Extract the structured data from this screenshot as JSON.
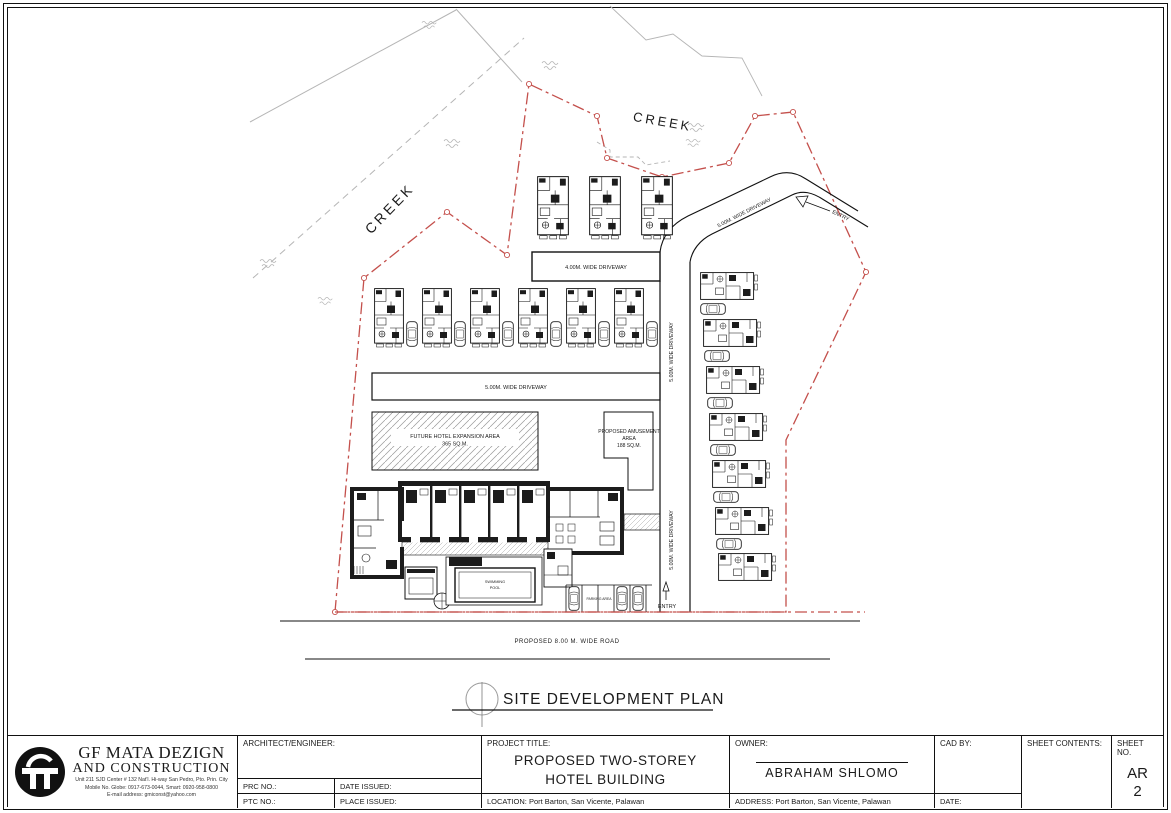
{
  "plan": {
    "title": "SITE DEVELOPMENT PLAN",
    "labels": {
      "creek_top": "CREEK",
      "creek_left": "CREEK",
      "driveway_top": "4.00M. WIDE DRIVEWAY",
      "driveway_mid": "5.00M. WIDE DRIVEWAY",
      "driveway_right_upper": "5.00M. WIDE DRIVEWAY",
      "driveway_right_lower": "5.00M. WIDE DRIVEWAY",
      "driveway_diag": "5.00M. WIDE DRIVEWAY",
      "entry_top": "ENTRY",
      "entry_bottom": "ENTRY",
      "expansion_line1": "FUTURE HOTEL EXPANSION AREA",
      "expansion_line2": "365 SQ.M.",
      "amusement_line1": "PROPOSED AMUSEMENT",
      "amusement_line2": "AREA",
      "amusement_line3": "188 SQ.M.",
      "pool_line1": "SWIMMING",
      "pool_line2": "POOL",
      "parking": "PARKING AREA",
      "road": "PROPOSED 8.00 M. WIDE ROAD"
    },
    "colors": {
      "boundary": "#c4504c",
      "creek": "#b5b5b5"
    }
  },
  "title_block": {
    "company": {
      "name_line1": "GF MATA DEZIGN",
      "name_line2": "AND CONSTRUCTION",
      "address": "Unit 211 SJD Center # 132 Nat'l. Hi-way San Pedro, Pto. Prin. City",
      "mobile": "Mobile No. Globe: 0917-673-0044, Smart: 0920-958-0800",
      "email": "E-mail address: gmiconst@yahoo.com"
    },
    "architect_label": "ARCHITECT/ENGINEER:",
    "prc_label": "PRC NO.:",
    "date_issued_label": "DATE ISSUED:",
    "ptc_label": "PTC NO.:",
    "place_issued_label": "PLACE ISSUED:",
    "project_title_label": "PROJECT TITLE:",
    "project_title_line1": "PROPOSED TWO-STOREY",
    "project_title_line2": "HOTEL BUILDING",
    "location": "LOCATION: Port Barton, San Vicente, Palawan",
    "owner_label": "OWNER:",
    "owner_name": "ABRAHAM SHLOMO",
    "address": "ADDRESS: Port Barton, San Vicente, Palawan",
    "cad_by_label": "CAD BY:",
    "date_label": "DATE:",
    "sheet_contents_label": "SHEET CONTENTS:",
    "sheet_no_label": "SHEET NO.",
    "sheet_no_line1": "AR",
    "sheet_no_line2": "2"
  }
}
